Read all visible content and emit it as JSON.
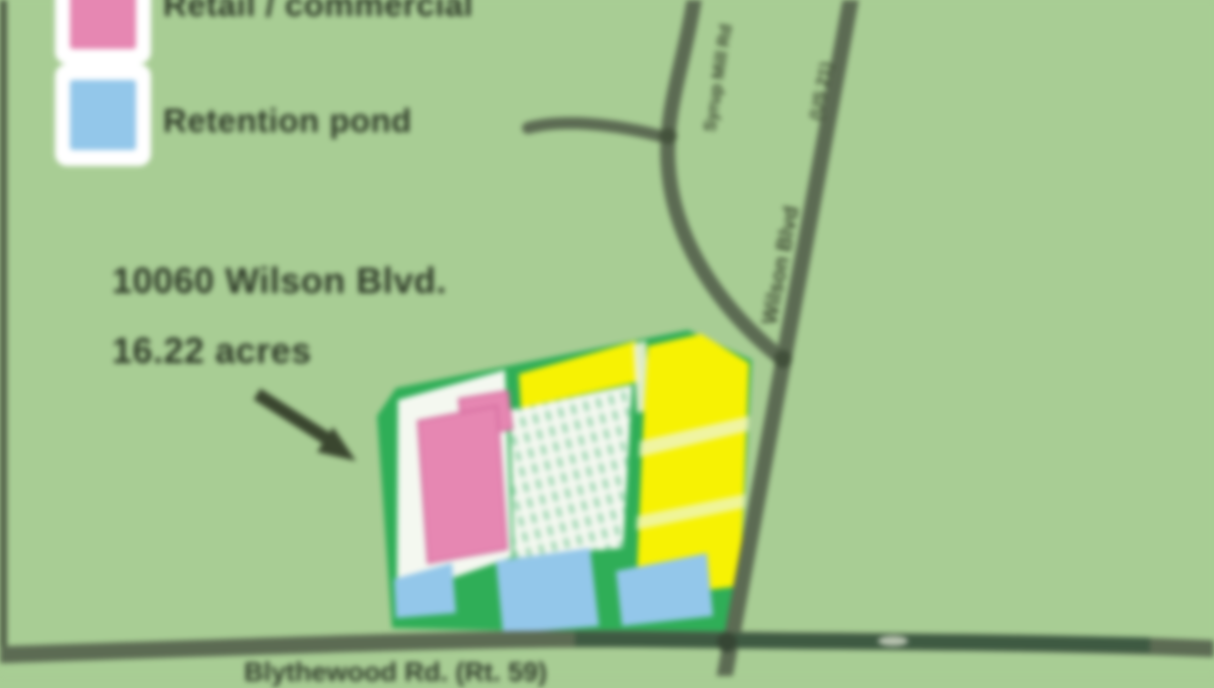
{
  "legend": {
    "item1_label": "Retail / commercial",
    "item2_label": "Retention pond"
  },
  "annotation": {
    "line1": "10060 Wilson Blvd.",
    "line2": "16.22 acres"
  },
  "road_labels": {
    "diagonal": "Wilson Blvd",
    "diagonal_route": "(US 21)",
    "curve": "Syrup Mill Rd",
    "bottom": "Blythewood Rd. (Rt. 59)"
  },
  "colors": {
    "background": "#a8cd94",
    "road": "#5c6b53",
    "road_dark": "#4e5c46",
    "site_green": "#2fae57",
    "zone_white": "#f4f8f0",
    "yellow": "#f7f203",
    "pink": "#e687b2",
    "pink_border": "#d2699c",
    "blue": "#93c7ea",
    "drive_band": "#eef5bd",
    "divider_band": "#eef2d6"
  }
}
